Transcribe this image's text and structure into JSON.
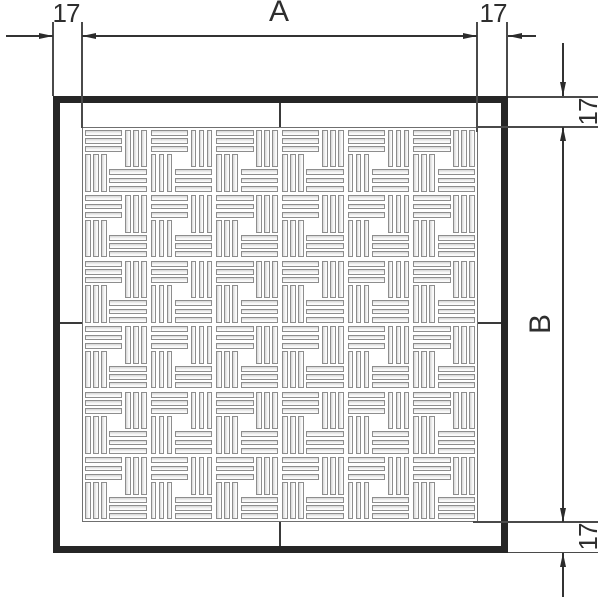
{
  "drawing": {
    "type": "technical-dimension-drawing",
    "subject": "square grate with pinwheel slot pattern",
    "dimensions": {
      "horizontal": {
        "left_margin": "17",
        "width_label": "A",
        "right_margin": "17"
      },
      "vertical": {
        "top_margin": "17",
        "height_label": "B",
        "bottom_margin": "17"
      }
    },
    "grate": {
      "rows": 6,
      "cols": 6,
      "groups_per_tile": 4,
      "slats_per_group": 3
    },
    "colors": {
      "line": "#333333",
      "frame": "#262626",
      "slat_border": "#8d8d8d",
      "slat_shade": "#d5d5d5",
      "background": "#ffffff"
    }
  }
}
